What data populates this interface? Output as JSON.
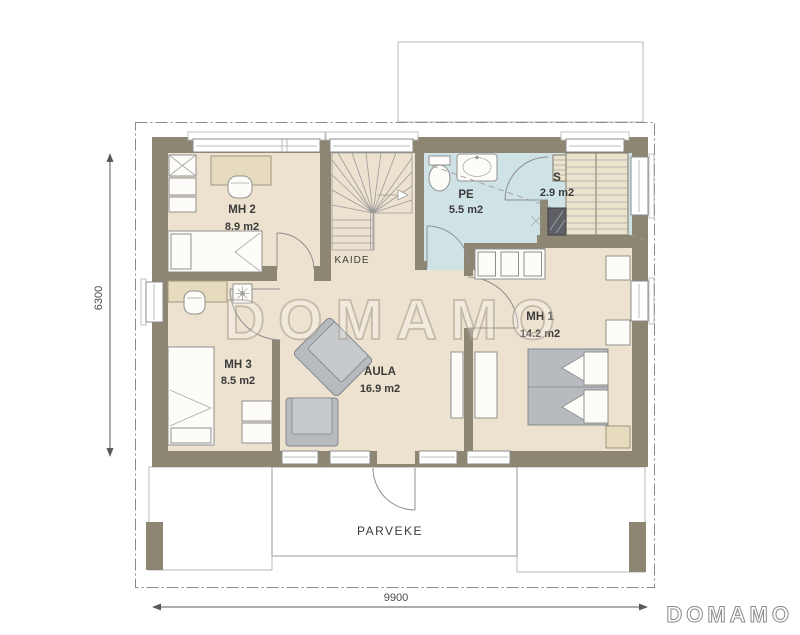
{
  "watermark": "DOMAMO",
  "logo": "DOMAMO",
  "dimensions": {
    "width_mm": "9900",
    "depth_mm": "6300"
  },
  "labels": {
    "stairs_railing": "KAIDE",
    "balcony": "PARVEKE"
  },
  "rooms": [
    {
      "name": "MH 2",
      "area": "8.9 m2"
    },
    {
      "name": "MH 3",
      "area": "8.5 m2"
    },
    {
      "name": "AULA",
      "area": "16.9 m2"
    },
    {
      "name": "MH 1",
      "area": "14.2 m2"
    },
    {
      "name": "PE",
      "area": "5.5 m2"
    },
    {
      "name": "S",
      "area": "2.9 m2"
    }
  ],
  "colors": {
    "wall": "#8d8673",
    "floor": "#ece2cf",
    "wet_room": "#cfe2e6",
    "furniture_gray": "#b7bbbf",
    "background": "#ffffff"
  }
}
